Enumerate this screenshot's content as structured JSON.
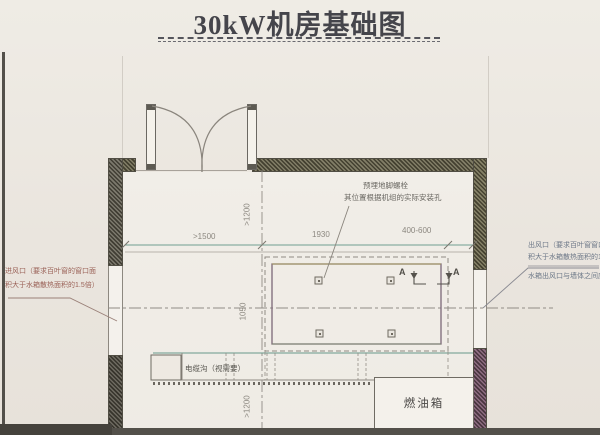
{
  "title": {
    "text": "30kW机房基础图"
  },
  "labels": {
    "section_a": "A",
    "fuel_tank": "燃油箱",
    "cable_trench": "电缆沟（视需要）"
  },
  "annotations": {
    "anchor_line1": "预埋地脚螺栓",
    "anchor_line2": "其位置根据机组的实际安装孔",
    "inlet_line1": "进风口（要求百叶窗的窗口面",
    "inlet_line2": "积大于水箱散热面积的1.5倍）",
    "outlet_line1": "出风口（要求百叶窗窗口面",
    "outlet_line2": "积大于水箱散热面积的1.5倍）",
    "outlet_line3": "水箱出风口与墙体之间应留"
  },
  "dimensions": {
    "width_left": ">1500",
    "width_center": "1930",
    "width_right": "400-600",
    "height_top": ">1200",
    "height_mid": "1050",
    "height_bottom": ">1200"
  },
  "colors": {
    "paper": "#eae6df",
    "wall_olive": "#6e6a52",
    "wall_purple": "#7a5570",
    "dim_line_teal": "#6f9e92",
    "ink_gray": "#8f8a84"
  }
}
